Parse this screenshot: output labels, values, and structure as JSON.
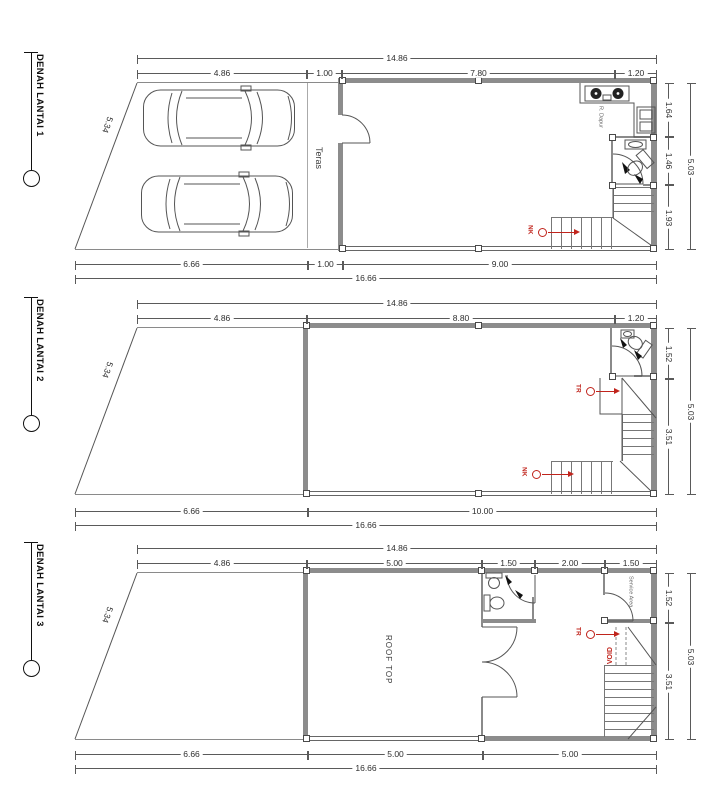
{
  "palette": {
    "ink": "#3a3a3a",
    "wall_gray": "#8c8c8c",
    "stair_red": "#c0241c",
    "background": "#ffffff"
  },
  "floors": [
    {
      "title": "DENAH LANTAI 1",
      "dims": {
        "top_total": "14.86",
        "top": [
          "4.86",
          "1.00",
          "7.80",
          "1.20"
        ],
        "right": [
          "1.64",
          "1.46",
          "1.93"
        ],
        "right_total": "5.03",
        "bottom": [
          "6.66",
          "1.00",
          "9.00"
        ],
        "bottom_total": "16.66",
        "slant": "5.34"
      },
      "labels": {
        "teras": "Teras",
        "kitchen": "R. Dapur",
        "stair_up": "NK"
      }
    },
    {
      "title": "DENAH LANTAI 2",
      "dims": {
        "top_total": "14.86",
        "top": [
          "4.86",
          "8.80",
          "1.20"
        ],
        "right": [
          "1.52",
          "3.51"
        ],
        "right_total": "5.03",
        "bottom": [
          "6.66",
          "10.00"
        ],
        "bottom_total": "16.66",
        "slant": "5.34"
      },
      "labels": {
        "stair_down": "TR",
        "stair_up": "NK"
      }
    },
    {
      "title": "DENAH LANTAI 3",
      "dims": {
        "top_total": "14.86",
        "top": [
          "4.86",
          "5.00",
          "1.50",
          "2.00",
          "1.50"
        ],
        "right": [
          "1.52",
          "3.51"
        ],
        "right_total": "5.03",
        "bottom": [
          "6.66",
          "5.00",
          "5.00"
        ],
        "bottom_total": "16.66",
        "slant": "5.34"
      },
      "labels": {
        "rooftop": "ROOF TOP",
        "service": "Service Area",
        "void": "VOID",
        "stair_down": "TR"
      }
    }
  ]
}
